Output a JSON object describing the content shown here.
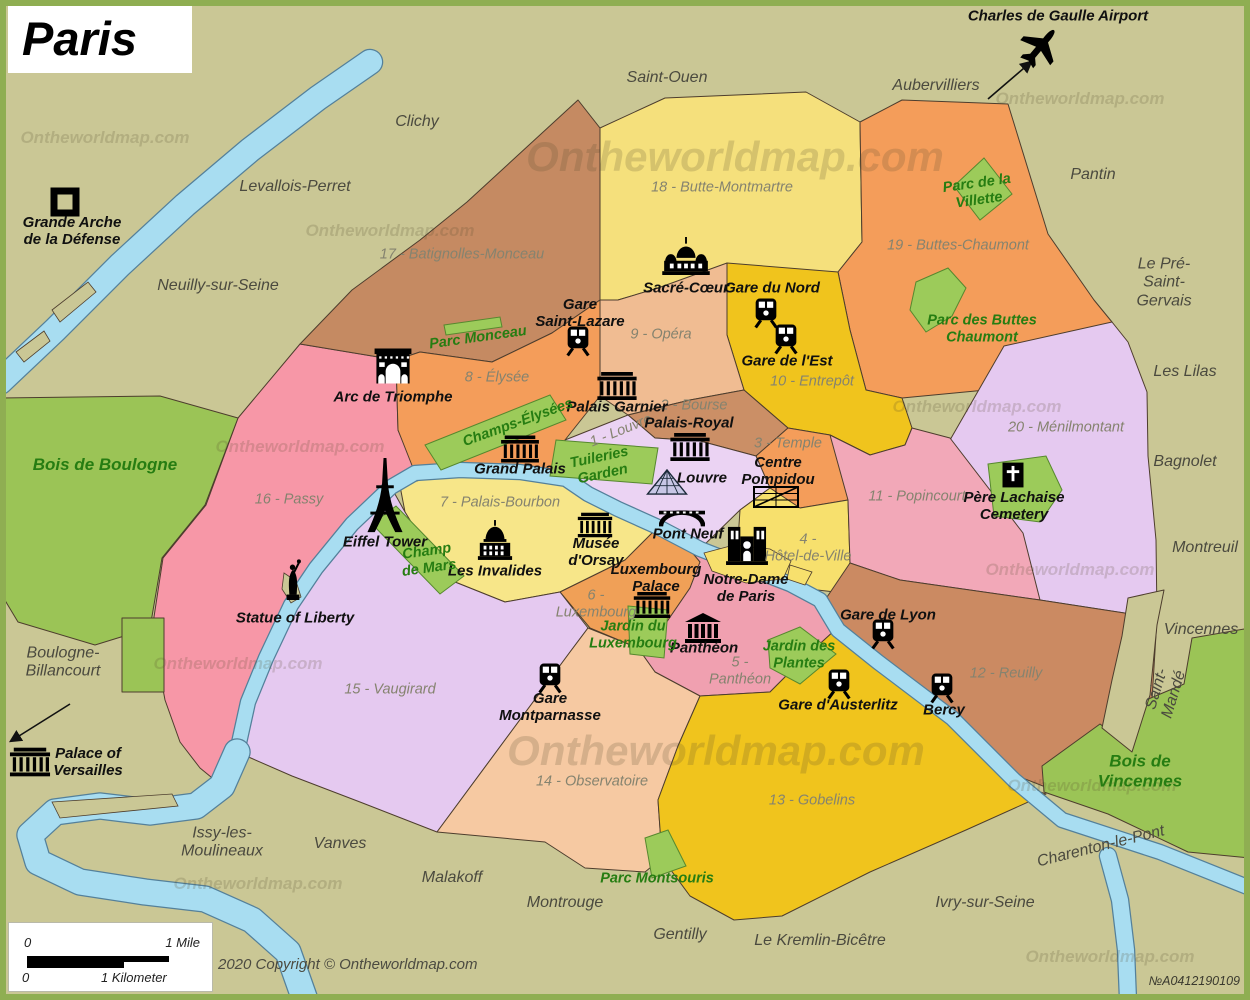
{
  "title": "Paris",
  "copyright": "2020 Copyright © Ontheworldmap.com",
  "ref_number": "№A0412190109",
  "watermark_text": "Ontheworldmap.com",
  "scale": {
    "mile_zero": "0",
    "mile_label": "1 Mile",
    "km_zero": "0",
    "km_label": "1 Kilometer"
  },
  "colors": {
    "background": "#cac795",
    "border": "#8fae52",
    "outline": "#4d3d2d",
    "river": "#a8ddf1",
    "river_outline": "#54809a",
    "park": "#9ccb5a",
    "park_outline": "#56882e"
  },
  "map": {
    "regions": [
      {
        "n": "16-passy",
        "c": "#f797a7",
        "p": "300,344 396,360 398,430 415,470 391,487 352,524 316,568 291,605 266,658 248,702 237,752 222,786 200,768 180,742 165,700 152,630 163,558 206,505 238,418"
      },
      {
        "n": "17-batignolles-monceau",
        "c": "#c58a62",
        "p": "467,202 578,100 600,128 600,300 552,333 492,362 420,352 396,360 300,344 352,290 420,240"
      },
      {
        "n": "18-butte-montmartre",
        "c": "#f5e07c",
        "p": "600,128 665,98 806,92 860,122 862,242 838,272 744,270 658,288 618,300 600,300"
      },
      {
        "n": "19-buttes-chaumont",
        "c": "#f49d5a",
        "p": "860,122 902,100 1008,104 1016,130 1048,234 1094,300 1112,322 1054,362 986,390 902,398 866,390 850,330 838,272 862,242"
      },
      {
        "n": "20-menilmontant",
        "c": "#e5c9f0",
        "p": "1004,346 1112,322 1128,342 1147,392 1148,456 1156,540 1157,618 1040,600 966,546 942,480 950,440"
      },
      {
        "n": "10-entrepot",
        "c": "#f0c41d",
        "p": "727,263 838,272 850,330 866,390 902,398 912,428 905,445 870,455 830,435 788,428 744,390 727,335"
      },
      {
        "n": "9-opera",
        "c": "#f0bc92",
        "p": "600,300 618,300 658,288 727,263 727,335 744,390 690,400 628,415 600,396"
      },
      {
        "n": "8-elysee",
        "c": "#f49d5a",
        "p": "396,360 420,352 492,362 552,333 600,300 600,396 565,440 566,479 520,472 460,470 415,473 398,430"
      },
      {
        "n": "2-bourse",
        "c": "#cb8f66",
        "p": "628,415 690,400 744,390 788,428 756,456 700,441 655,438"
      },
      {
        "n": "3-temple",
        "c": "#f49d5a",
        "p": "756,456 788,428 830,435 870,455 848,500 800,508 770,488"
      },
      {
        "n": "1-louvre",
        "c": "#ebd3f3",
        "p": "565,440 628,415 655,438 700,441 756,456 770,488 740,510 700,549 658,527 618,509 588,494 566,479"
      },
      {
        "n": "4-hotel-de-ville",
        "c": "#f7e06d",
        "p": "770,488 800,508 848,500 850,563 835,592 800,588 762,572 746,567 737,556 740,510"
      },
      {
        "n": "11-popincourt",
        "c": "#f2a8b8",
        "p": "830,435 870,455 905,445 912,428 950,438 1023,533 1040,600 900,580 850,563 848,500"
      },
      {
        "n": "12-reuilly",
        "c": "#cb8a62",
        "p": "850,563 900,580 1040,600 1157,618 1152,700 1108,745 1048,788 1015,775 955,715 890,672 860,648 838,625 825,600"
      },
      {
        "n": "7-palais-bourbon",
        "c": "#f7e689",
        "p": "400,486 430,477 500,473 565,480 590,497 620,512 655,530 648,558 625,560 560,592 505,602 455,582 425,545 405,512"
      },
      {
        "n": "6-luxembourg",
        "c": "#f0a057",
        "p": "625,560 655,530 690,548 700,562 690,588 664,626 638,648 590,628 560,592"
      },
      {
        "n": "5-pantheon",
        "c": "#f0a0b0",
        "p": "690,550 746,570 790,590 822,606 835,630 800,662 770,692 700,696 655,672 638,648 664,626 690,588 700,562"
      },
      {
        "n": "15-vaugirard",
        "c": "#e5c9f0",
        "p": "391,487 405,512 425,545 455,582 505,602 560,592 588,628 570,652 437,832 360,802 292,776 237,752 248,702 266,658 291,605 316,568 352,524"
      },
      {
        "n": "14-observatoire",
        "c": "#f6c9a2",
        "p": "570,652 588,628 638,648 655,672 700,696 678,746 658,800 662,858 645,872 585,868 545,842 437,832"
      },
      {
        "n": "13-gobelins",
        "c": "#f0c41d",
        "p": "700,696 770,692 800,662 835,630 875,665 950,722 1012,782 1046,794 966,830 870,872 782,916 734,920 690,896 662,858 658,800 678,746"
      },
      {
        "n": "bois-de-boulogne",
        "c": "#9bc456",
        "p": "0,398 160,396 238,418 205,505 162,558 150,628 95,645 18,622 0,592"
      },
      {
        "n": "boulogne-strip",
        "c": "#9bc456",
        "p": "122,618 164,618 164,692 122,692"
      },
      {
        "n": "bois-de-vincennes",
        "c": "#9bc456",
        "p": "1042,766 1100,724 1132,748 1146,700 1184,684 1192,638 1250,628 1250,858 1188,852 1108,814 1044,792"
      },
      {
        "n": "saint-mande-wedge",
        "c": "#cac795",
        "p": "1128,598 1164,590 1157,625 1150,695 1132,752 1102,728 1112,680 1122,636"
      }
    ],
    "rivers": [
      {
        "n": "seine-northwest",
        "w": 24,
        "p": "370,62 318,98 250,150 185,205 120,265 55,330 0,382"
      },
      {
        "n": "seine-city",
        "w": 14,
        "p": "1250,888 1160,852 1062,820 1014,780 952,718 878,662 838,630 820,600 790,584 746,567 700,549 658,527 618,509 588,494 566,479 520,472 460,470 415,473 391,487 352,524 316,568 291,605 266,658 248,702 237,752"
      },
      {
        "n": "seine-southwest-loop",
        "w": 25,
        "p": "237,752 222,786 196,806 150,812 100,806 55,812 30,835 38,862 80,882 145,892 205,899 252,920 288,952 305,1000"
      },
      {
        "n": "marne-branch",
        "w": 16,
        "p": "1108,856 1120,900 1126,950 1128,1000"
      }
    ],
    "islands": [
      {
        "n": "ile-de-la-cite",
        "c": "#f7e06d",
        "p": "704,553 734,545 770,549 791,561 783,579 746,583 712,571"
      },
      {
        "n": "ile-saint-louis",
        "c": "#f7e06d",
        "p": "790,565 812,572 805,585 787,579"
      },
      {
        "n": "ile-aux-cygnes",
        "c": "#cac795",
        "p": "284,573 296,581 301,597 291,603 282,589"
      },
      {
        "n": "island-northwest-1",
        "c": "#cac795",
        "p": "52,310 88,282 96,292 60,322"
      },
      {
        "n": "island-northwest-2",
        "c": "#cac795",
        "p": "16,352 44,331 50,341 24,362"
      },
      {
        "n": "island-issy",
        "c": "#cac795",
        "p": "52,802 172,794 178,806 60,818"
      }
    ],
    "parks": [
      {
        "n": "parc-monceau",
        "p": "444,325 500,317 502,327 446,335"
      },
      {
        "n": "champs-elysees",
        "p": "425,445 550,395 566,420 441,470"
      },
      {
        "n": "tuileries-garden",
        "p": "556,440 658,448 652,484 550,476"
      },
      {
        "n": "champ-de-mars",
        "p": "372,524 396,506 464,576 440,594"
      },
      {
        "n": "jardin-du-luxembourg",
        "p": "628,606 668,610 664,658 630,654"
      },
      {
        "n": "jardin-des-plantes",
        "p": "768,640 800,627 836,654 800,684 770,668"
      },
      {
        "n": "parc-montsouris",
        "p": "645,838 668,830 686,866 652,878"
      },
      {
        "n": "parc-de-la-villette",
        "p": "954,186 984,158 1012,194 980,220"
      },
      {
        "n": "parc-des-buttes-chaumont",
        "p": "916,282 948,268 966,288 952,316 926,332 910,310"
      },
      {
        "n": "pere-lachaise-cemetery",
        "p": "988,464 1046,456 1062,490 1040,522 994,516"
      }
    ],
    "arrows": [
      {
        "n": "airport-arrow",
        "x1": 988,
        "y1": 99,
        "x2": 1031,
        "y2": 62
      },
      {
        "n": "versailles-arrow",
        "x1": 70,
        "y1": 704,
        "x2": 11,
        "y2": 741
      }
    ],
    "icons": [
      {
        "n": "grande-arche-icon",
        "sym": "arche",
        "x": 65,
        "y": 202,
        "w": 30,
        "h": 30
      },
      {
        "n": "plane-icon",
        "sym": "plane",
        "x": 1040,
        "y": 47,
        "w": 46,
        "h": 46,
        "r": 40
      },
      {
        "n": "sacre-coeur-icon",
        "sym": "basilica",
        "x": 686,
        "y": 256,
        "w": 48,
        "h": 38
      },
      {
        "n": "gare-du-nord-icon",
        "sym": "train",
        "x": 766,
        "y": 313,
        "w": 25,
        "h": 31
      },
      {
        "n": "gare-de-lest-icon",
        "sym": "train",
        "x": 786,
        "y": 339,
        "w": 25,
        "h": 31
      },
      {
        "n": "gare-saint-lazare-icon",
        "sym": "train",
        "x": 578,
        "y": 341,
        "w": 25,
        "h": 31
      },
      {
        "n": "arc-de-triomphe-icon",
        "sym": "arc",
        "x": 393,
        "y": 366,
        "w": 38,
        "h": 35
      },
      {
        "n": "palais-garnier-icon",
        "sym": "building",
        "x": 617,
        "y": 386,
        "w": 42,
        "h": 28
      },
      {
        "n": "palais-royal-icon",
        "sym": "building",
        "x": 690,
        "y": 447,
        "w": 42,
        "h": 28
      },
      {
        "n": "louvre-pyramid-icon",
        "sym": "pyramid",
        "x": 667,
        "y": 482,
        "w": 42,
        "h": 26
      },
      {
        "n": "centre-pompidou-icon",
        "sym": "pompidou",
        "x": 776,
        "y": 497,
        "w": 46,
        "h": 24
      },
      {
        "n": "grand-palais-icon",
        "sym": "building",
        "x": 520,
        "y": 449,
        "w": 40,
        "h": 27
      },
      {
        "n": "eiffel-tower-icon",
        "sym": "eiffel",
        "x": 385,
        "y": 497,
        "w": 36,
        "h": 78
      },
      {
        "n": "musee-dorsay-icon",
        "sym": "building",
        "x": 595,
        "y": 525,
        "w": 36,
        "h": 25
      },
      {
        "n": "les-invalides-icon",
        "sym": "dome",
        "x": 495,
        "y": 540,
        "w": 38,
        "h": 40
      },
      {
        "n": "pont-neuf-icon",
        "sym": "bridge",
        "x": 682,
        "y": 519,
        "w": 46,
        "h": 17
      },
      {
        "n": "notre-dame-icon",
        "sym": "cathedral",
        "x": 747,
        "y": 545,
        "w": 42,
        "h": 40
      },
      {
        "n": "luxembourg-palace-icon",
        "sym": "building",
        "x": 652,
        "y": 605,
        "w": 40,
        "h": 26
      },
      {
        "n": "pantheon-icon",
        "sym": "pantheon",
        "x": 703,
        "y": 628,
        "w": 36,
        "h": 30
      },
      {
        "n": "statue-of-liberty-icon",
        "sym": "statue",
        "x": 293,
        "y": 580,
        "w": 20,
        "h": 45
      },
      {
        "n": "gare-montparnasse-icon",
        "sym": "train",
        "x": 550,
        "y": 678,
        "w": 25,
        "h": 31
      },
      {
        "n": "gare-de-lyon-icon",
        "sym": "train",
        "x": 883,
        "y": 634,
        "w": 25,
        "h": 31
      },
      {
        "n": "gare-dausterlitz-icon",
        "sym": "train",
        "x": 839,
        "y": 684,
        "w": 25,
        "h": 31
      },
      {
        "n": "bercy-icon",
        "sym": "train",
        "x": 942,
        "y": 688,
        "w": 25,
        "h": 31
      },
      {
        "n": "pere-lachaise-icon",
        "sym": "cross",
        "x": 1013,
        "y": 475,
        "w": 21,
        "h": 25
      },
      {
        "n": "versailles-icon",
        "sym": "building",
        "x": 30,
        "y": 762,
        "w": 42,
        "h": 30
      }
    ]
  },
  "labels": [
    {
      "t": "Saint-Ouen",
      "x": 667,
      "y": 78,
      "c": "suburb"
    },
    {
      "t": "Clichy",
      "x": 417,
      "y": 122,
      "c": "suburb"
    },
    {
      "t": "Levallois-Perret",
      "x": 295,
      "y": 187,
      "c": "suburb"
    },
    {
      "t": "Neuilly-sur-Seine",
      "x": 218,
      "y": 286,
      "c": "suburb"
    },
    {
      "t": "Aubervilliers",
      "x": 936,
      "y": 86,
      "c": "suburb"
    },
    {
      "t": "Pantin",
      "x": 1093,
      "y": 175,
      "c": "suburb"
    },
    {
      "t": "Le Pré-Saint-Gervais",
      "x": 1164,
      "y": 283,
      "c": "suburb"
    },
    {
      "t": "Les Lilas",
      "x": 1185,
      "y": 372,
      "c": "suburb"
    },
    {
      "t": "Bagnolet",
      "x": 1185,
      "y": 462,
      "c": "suburb"
    },
    {
      "t": "Montreuil",
      "x": 1205,
      "y": 548,
      "c": "suburb"
    },
    {
      "t": "Vincennes",
      "x": 1201,
      "y": 630,
      "c": "suburb"
    },
    {
      "t": "Saint-Mandé",
      "x": 1166,
      "y": 692,
      "c": "suburb",
      "r": -73
    },
    {
      "t": "Boulogne-\nBillancourt",
      "x": 63,
      "y": 663,
      "c": "suburb"
    },
    {
      "t": "Issy-les-\nMoulineaux",
      "x": 222,
      "y": 843,
      "c": "suburb"
    },
    {
      "t": "Vanves",
      "x": 340,
      "y": 844,
      "c": "suburb"
    },
    {
      "t": "Malakoff",
      "x": 452,
      "y": 878,
      "c": "suburb"
    },
    {
      "t": "Montrouge",
      "x": 565,
      "y": 903,
      "c": "suburb"
    },
    {
      "t": "Gentilly",
      "x": 680,
      "y": 935,
      "c": "suburb"
    },
    {
      "t": "Le Kremlin-Bicêtre",
      "x": 820,
      "y": 941,
      "c": "suburb"
    },
    {
      "t": "Ivry-sur-Seine",
      "x": 985,
      "y": 903,
      "c": "suburb"
    },
    {
      "t": "Charenton-le-Pont",
      "x": 1101,
      "y": 847,
      "c": "suburb",
      "r": -14
    },
    {
      "t": "18 - Butte-Montmartre",
      "x": 722,
      "y": 188,
      "c": "district"
    },
    {
      "t": "17 - Batignolles-Monceau",
      "x": 462,
      "y": 255,
      "c": "district"
    },
    {
      "t": "19 - Buttes-Chaumont",
      "x": 958,
      "y": 246,
      "c": "district"
    },
    {
      "t": "9 - Opéra",
      "x": 661,
      "y": 335,
      "c": "district"
    },
    {
      "t": "10 - Entrepôt",
      "x": 812,
      "y": 382,
      "c": "district"
    },
    {
      "t": "8 - Élysée",
      "x": 497,
      "y": 378,
      "c": "district"
    },
    {
      "t": "2 - Bourse",
      "x": 694,
      "y": 406,
      "c": "district"
    },
    {
      "t": "1 - Louvre",
      "x": 621,
      "y": 431,
      "c": "district",
      "r": -22
    },
    {
      "t": "3 - Temple",
      "x": 788,
      "y": 444,
      "c": "district"
    },
    {
      "t": "20 - Ménilmontant",
      "x": 1066,
      "y": 428,
      "c": "district"
    },
    {
      "t": "11 - Popincourt",
      "x": 917,
      "y": 497,
      "c": "district"
    },
    {
      "t": "16 - Passy",
      "x": 289,
      "y": 500,
      "c": "district"
    },
    {
      "t": "7 - Palais-Bourbon",
      "x": 500,
      "y": 503,
      "c": "district"
    },
    {
      "t": "4 -\nHôtel-de-Ville",
      "x": 808,
      "y": 548,
      "c": "district"
    },
    {
      "t": "6 -\nLuxembourg",
      "x": 596,
      "y": 604,
      "c": "district"
    },
    {
      "t": "5 -\nPanthéon",
      "x": 740,
      "y": 671,
      "c": "district"
    },
    {
      "t": "12 - Reuilly",
      "x": 1006,
      "y": 674,
      "c": "district"
    },
    {
      "t": "15 - Vaugirard",
      "x": 390,
      "y": 690,
      "c": "district"
    },
    {
      "t": "14 - Observatoire",
      "x": 592,
      "y": 782,
      "c": "district"
    },
    {
      "t": "13 - Gobelins",
      "x": 812,
      "y": 801,
      "c": "district"
    },
    {
      "t": "Grande Arche\nde la Défense",
      "x": 72,
      "y": 231,
      "c": "landmark"
    },
    {
      "t": "Charles de Gaulle Airport",
      "x": 1058,
      "y": 16,
      "c": "landmark"
    },
    {
      "t": "Sacré-Cœur",
      "x": 686,
      "y": 288,
      "c": "landmark"
    },
    {
      "t": "Gare du Nord",
      "x": 772,
      "y": 288,
      "c": "landmark"
    },
    {
      "t": "Gare\nSaint-Lazare",
      "x": 580,
      "y": 313,
      "c": "landmark"
    },
    {
      "t": "Gare de l'Est",
      "x": 787,
      "y": 361,
      "c": "landmark"
    },
    {
      "t": "Arc de Triomphe",
      "x": 393,
      "y": 397,
      "c": "landmark"
    },
    {
      "t": "Palais Garnier",
      "x": 617,
      "y": 407,
      "c": "landmark"
    },
    {
      "t": "Palais-Royal",
      "x": 689,
      "y": 423,
      "c": "landmark"
    },
    {
      "t": "Louvre",
      "x": 702,
      "y": 478,
      "c": "landmark"
    },
    {
      "t": "Centre\nPompidou",
      "x": 778,
      "y": 471,
      "c": "landmark"
    },
    {
      "t": "Grand Palais",
      "x": 520,
      "y": 469,
      "c": "landmark"
    },
    {
      "t": "Eiffel Tower",
      "x": 385,
      "y": 542,
      "c": "landmark"
    },
    {
      "t": "Musée\nd'Orsay",
      "x": 596,
      "y": 552,
      "c": "landmark"
    },
    {
      "t": "Les Invalides",
      "x": 495,
      "y": 571,
      "c": "landmark"
    },
    {
      "t": "Pont Neuf",
      "x": 688,
      "y": 534,
      "c": "landmark"
    },
    {
      "t": "Notre-Dame\nde Paris",
      "x": 746,
      "y": 588,
      "c": "landmark"
    },
    {
      "t": "Luxembourg\nPalace",
      "x": 656,
      "y": 578,
      "c": "landmark"
    },
    {
      "t": "Panthéon",
      "x": 704,
      "y": 648,
      "c": "landmark"
    },
    {
      "t": "Statue of Liberty",
      "x": 295,
      "y": 618,
      "c": "landmark"
    },
    {
      "t": "Gare\nMontparnasse",
      "x": 550,
      "y": 707,
      "c": "landmark"
    },
    {
      "t": "Gare de Lyon",
      "x": 888,
      "y": 615,
      "c": "landmark"
    },
    {
      "t": "Gare d'Austerlitz",
      "x": 838,
      "y": 705,
      "c": "landmark"
    },
    {
      "t": "Bercy",
      "x": 944,
      "y": 710,
      "c": "landmark"
    },
    {
      "t": "Père Lachaise\nCemetery",
      "x": 1014,
      "y": 506,
      "c": "landmark"
    },
    {
      "t": "Palace of\nVersailles",
      "x": 88,
      "y": 762,
      "c": "landmark"
    },
    {
      "t": "Bois de Boulogne",
      "x": 105,
      "y": 465,
      "c": "park",
      "s": 17
    },
    {
      "t": "Bois de Vincennes",
      "x": 1140,
      "y": 771,
      "c": "park",
      "s": 17
    },
    {
      "t": "Parc Monceau",
      "x": 478,
      "y": 338,
      "c": "park",
      "r": -8
    },
    {
      "t": "Champs-Élysées",
      "x": 518,
      "y": 423,
      "c": "park",
      "r": -20
    },
    {
      "t": "Tuileries\nGarden",
      "x": 601,
      "y": 466,
      "c": "park",
      "r": -12
    },
    {
      "t": "Champ\nde Mars",
      "x": 428,
      "y": 560,
      "c": "park",
      "r": -8
    },
    {
      "t": "Jardin du\nLuxembourg",
      "x": 633,
      "y": 635,
      "c": "park"
    },
    {
      "t": "Jardin des\nPlantes",
      "x": 799,
      "y": 655,
      "c": "park"
    },
    {
      "t": "Parc Montsouris",
      "x": 657,
      "y": 879,
      "c": "park"
    },
    {
      "t": "Parc de la\nVillette",
      "x": 978,
      "y": 192,
      "c": "park",
      "r": -8
    },
    {
      "t": "Parc des Buttes\nChaumont",
      "x": 982,
      "y": 329,
      "c": "park"
    }
  ],
  "watermarks": [
    {
      "x": 735,
      "y": 157,
      "s": 42
    },
    {
      "x": 716,
      "y": 751,
      "s": 42
    },
    {
      "x": 105,
      "y": 138,
      "s": 17
    },
    {
      "x": 390,
      "y": 231,
      "s": 17
    },
    {
      "x": 1080,
      "y": 99,
      "s": 17
    },
    {
      "x": 300,
      "y": 447,
      "s": 17
    },
    {
      "x": 977,
      "y": 407,
      "s": 17
    },
    {
      "x": 1070,
      "y": 570,
      "s": 17
    },
    {
      "x": 238,
      "y": 664,
      "s": 17
    },
    {
      "x": 258,
      "y": 884,
      "s": 17
    },
    {
      "x": 1092,
      "y": 786,
      "s": 17
    },
    {
      "x": 1110,
      "y": 957,
      "s": 17
    }
  ]
}
